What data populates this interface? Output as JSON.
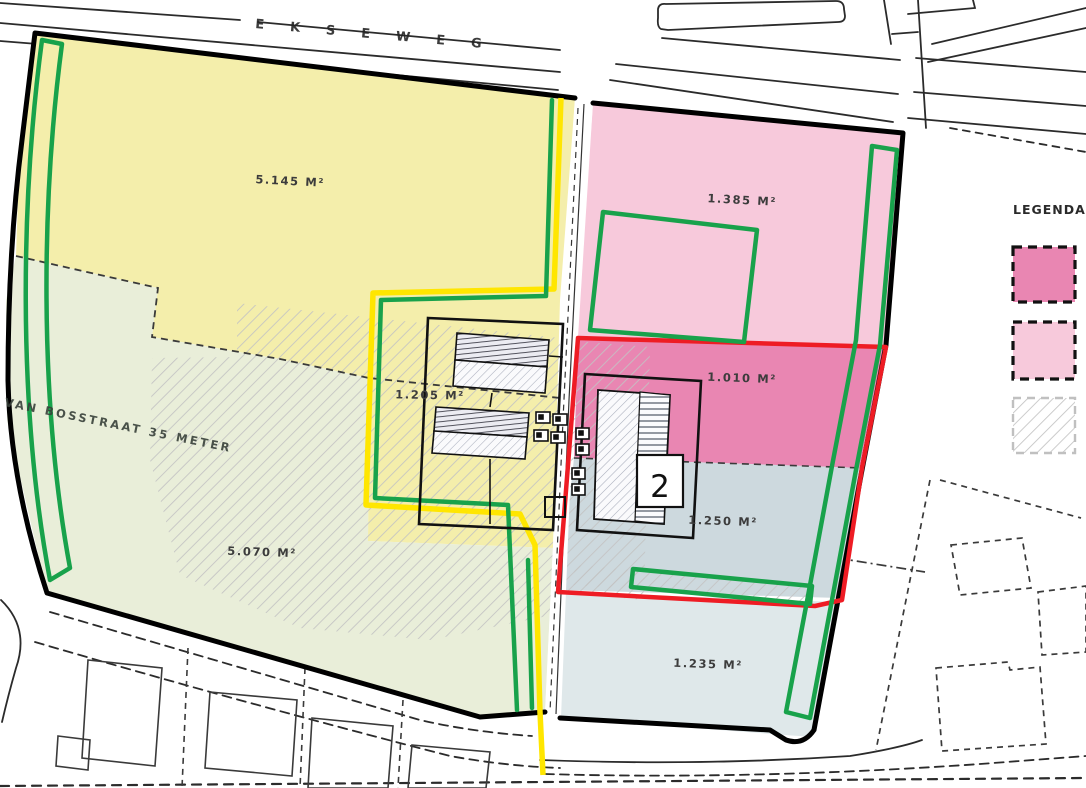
{
  "map": {
    "streets": {
      "top_road": "EKSEWEG",
      "left_road": "VAN BOSSTRAAT 35 METER"
    },
    "parcels": [
      {
        "name": "north-west-parcel",
        "area_label": "5.145 M²"
      },
      {
        "name": "south-west-parcel",
        "area_label": "5.070 M²"
      },
      {
        "name": "center-parcel",
        "area_label": "1.205 M²"
      },
      {
        "name": "north-east-parcel",
        "area_label": "1.385 M²"
      },
      {
        "name": "east-parcel",
        "area_label": "1.010 M²"
      },
      {
        "name": "mid-east-parcel",
        "area_label": "1.250 M²"
      },
      {
        "name": "south-east-parcel",
        "area_label": "1.235 M²"
      }
    ],
    "building_marker": "2",
    "legend": {
      "title": "LEGENDA"
    }
  },
  "colors": {
    "parcel_yellow": "#f4eeab",
    "parcel_green": "#e9eed9",
    "parcel_pink_light": "#f7c9db",
    "parcel_pink_dark": "#e986b2",
    "parcel_blue_mid": "#cdd9de",
    "parcel_blue_south": "#dfe8ea",
    "outline_green": "#18a24b",
    "outline_yellow": "#ffe600",
    "outline_red": "#ee1c24",
    "boundary_black": "#000000"
  }
}
